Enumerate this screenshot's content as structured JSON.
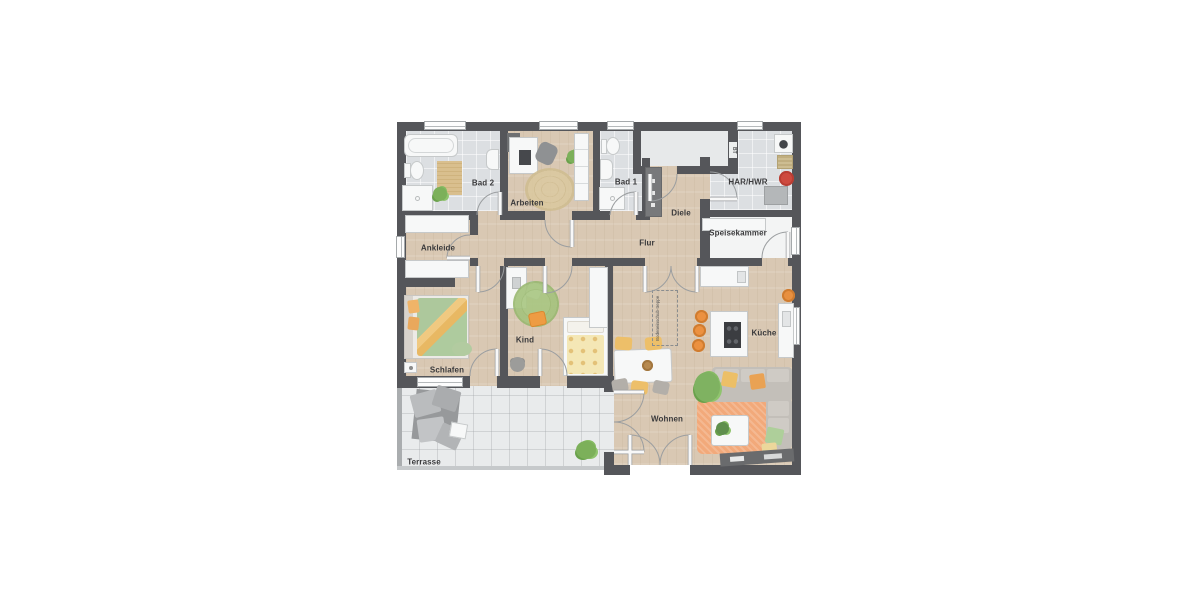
{
  "rooms": {
    "bad2": {
      "label": "Bad 2"
    },
    "arbeiten": {
      "label": "Arbeiten"
    },
    "bad1": {
      "label": "Bad 1"
    },
    "har_hwr": {
      "label": "HAR/HWR"
    },
    "diele": {
      "label": "Diele"
    },
    "ankleide": {
      "label": "Ankleide"
    },
    "flur": {
      "label": "Flur"
    },
    "speisekammer": {
      "label": "Speisekammer"
    },
    "schlafen": {
      "label": "Schlafen"
    },
    "kind": {
      "label": "Kind"
    },
    "kueche": {
      "label": "Küche"
    },
    "wohnen": {
      "label": "Wohnen"
    },
    "terrasse": {
      "label": "Terrasse"
    }
  },
  "annotations": {
    "attic_ladder": {
      "label": "Bodeneinschub-treppe"
    },
    "bt": {
      "label": "BT"
    }
  },
  "colors": {
    "wall": "#55565a",
    "wood_floor": "#d9c8b3",
    "bath_tile": "#dcdfe2",
    "pantry_floor": "#f3f4f4",
    "terrace_floor": "#e9ebec",
    "accent_orange": "#ec9140",
    "rug_orange": "#f4a878",
    "rug_green": "#a3c37e",
    "rug_jute": "#dbc9a0",
    "bed_green": "#adc89c",
    "bed_yellow": "#f4e7b5",
    "sofa_gray": "#c3bfb9",
    "robot_red": "#ce4a3f"
  }
}
